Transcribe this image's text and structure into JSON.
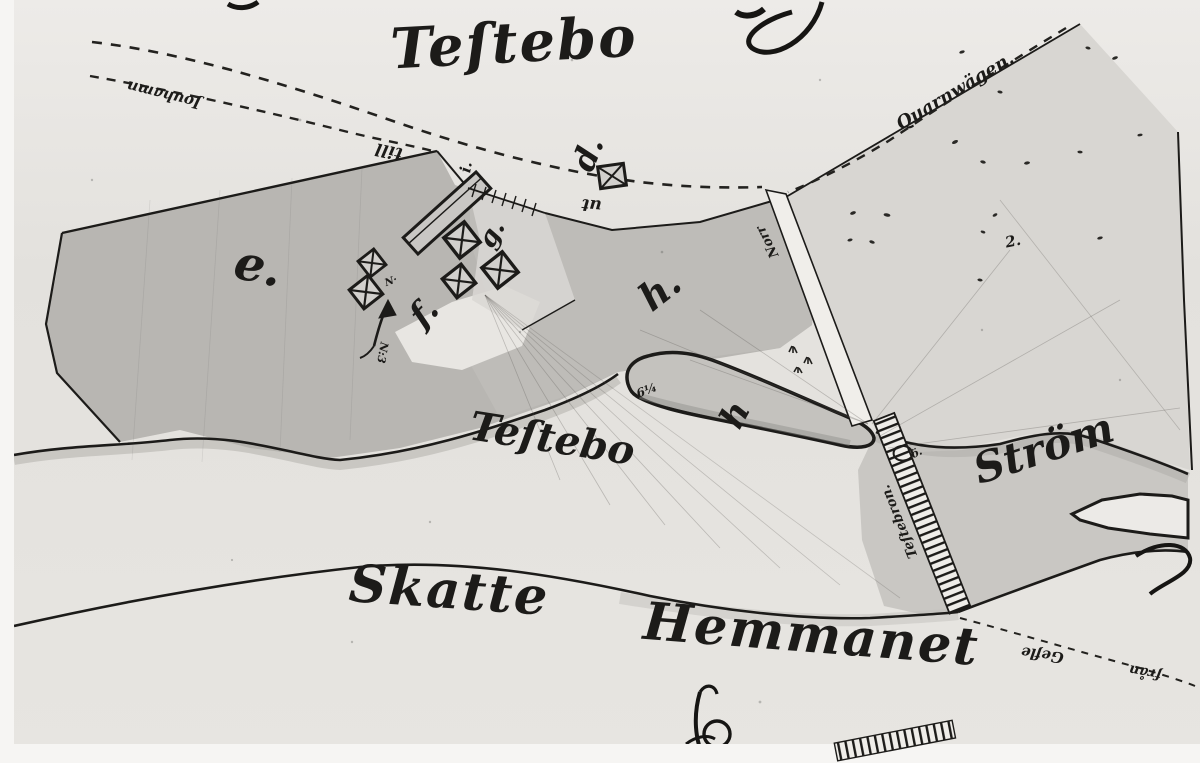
{
  "map": {
    "titles": {
      "testebo_top": "Teſtebo",
      "testebo_mid": "Teſtebo",
      "strom": "Ström",
      "skatte": "Skatte",
      "hemmanet": "Hemmanet"
    },
    "roads": {
      "jouhamn": "Jouhamn",
      "quarnwagen": "Quarnwägen.",
      "till": "till",
      "ut": "ut",
      "norr": "Norr",
      "bridge_name": "Teſtebron.",
      "gefle": "Gefle",
      "fran": "från"
    },
    "letters": {
      "e": "e.",
      "f": "f.",
      "g": "g.",
      "h_field": "h.",
      "h_island": "h",
      "d": "d.",
      "i": "i."
    },
    "notes": {
      "n_mark": "N·",
      "n3": "N:3",
      "six_quarter": "6¼",
      "two": "2.",
      "o_mark": "ö."
    },
    "colors": {
      "ink": "#1c1b19",
      "paper": "#e4e2de",
      "paper_light": "#eceae7",
      "field": "#b8b6b2",
      "field_light": "#c1bfbb",
      "right_field": "#d8d6d2",
      "water": "#c9c7c3",
      "island": "#c4c2be",
      "white_band": "#f0eeea",
      "photo_border": "#f6f5f3"
    }
  }
}
